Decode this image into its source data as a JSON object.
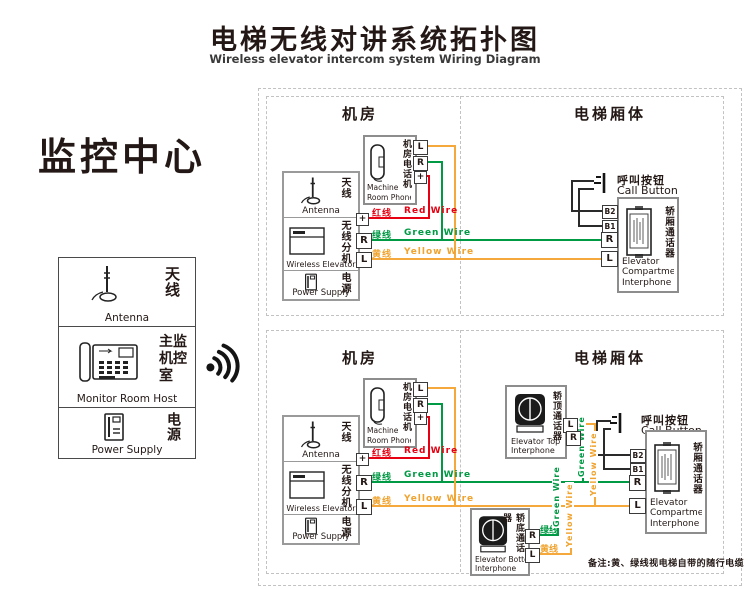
{
  "page": {
    "title_zh": "电梯无线对讲系统拓扑图",
    "title_en": "Wireless elevator intercom system Wiring Diagram",
    "note": "备注:黄、绿线视电梯自带的随行电缆"
  },
  "colors": {
    "red": "#e60012",
    "green": "#009944",
    "yellow": "#f5a93c",
    "box_border": "#8d8d8d"
  },
  "monitoring_center": {
    "title": "监控中心",
    "antenna": {
      "zh": "天线",
      "en": "Antenna"
    },
    "host": {
      "zh_lines": [
        "主监",
        "机控",
        "室"
      ],
      "en": "Monitor Room Host"
    },
    "power": {
      "zh": "电源",
      "en": "Power Supply"
    }
  },
  "upper": {
    "room_label": "机房",
    "car_label": "电梯厢体",
    "machine_phone": {
      "zh": "机房电话机",
      "en1": "Machine",
      "en2": "Room Phone",
      "t_l": "L",
      "t_r": "R",
      "t_plus": "+"
    },
    "station": {
      "antenna_zh": "天线",
      "antenna_en": "Antenna",
      "wireless_zh": "无线分机",
      "wireless_en": "Wireless Elevator",
      "power_zh": "电源",
      "power_en": "Power Supply",
      "t_plus": "+",
      "t_r": "R",
      "t_l": "L"
    },
    "wire_red": {
      "zh": "红线",
      "en": "Red Wire"
    },
    "wire_green": {
      "zh": "绿线",
      "en": "Green Wire"
    },
    "wire_yellow": {
      "zh": "黄线",
      "en": "Yellow Wire"
    },
    "call_button": {
      "zh": "呼叫按钮",
      "en": "Call Button"
    },
    "interphone": {
      "zh": "轿厢通话器",
      "en1": "Elevator",
      "en2": "Compartment",
      "en3": "Interphone",
      "t_b2": "B2",
      "t_b1": "B1",
      "t_r": "R",
      "t_l": "L"
    }
  },
  "lower": {
    "room_label": "机房",
    "car_label": "电梯厢体",
    "machine_phone": {
      "zh": "机房电话机",
      "en1": "Machine",
      "en2": "Room Phone",
      "t_l": "L",
      "t_r": "R",
      "t_plus": "+"
    },
    "station": {
      "antenna_zh": "天线",
      "antenna_en": "Antenna",
      "wireless_zh": "无线分机",
      "wireless_en": "Wireless Elevator",
      "power_zh": "电源",
      "power_en": "Power Supply",
      "t_plus": "+",
      "t_r": "R",
      "t_l": "L"
    },
    "wire_red": {
      "zh": "红线",
      "en": "Red Wire"
    },
    "wire_green": {
      "zh": "绿线",
      "en": "Green Wire"
    },
    "wire_yellow": {
      "zh": "黄线",
      "en": "Yellow Wire"
    },
    "call_button": {
      "zh": "呼叫按钮",
      "en": "Call Button"
    },
    "interphone": {
      "zh": "轿厢通话器",
      "en1": "Elevator",
      "en2": "Compartment",
      "en3": "Interphone",
      "t_b2": "B2",
      "t_b1": "B1",
      "t_r": "R",
      "t_l": "L"
    },
    "top_interphone": {
      "zh": "轿顶通话器",
      "en1": "Elevator Top",
      "en2": "Interphone",
      "t_l": "L",
      "t_r": "R"
    },
    "bottom_interphone": {
      "zh": "轿底通话器",
      "en1": "Elevator Bottom",
      "en2": "Interphone",
      "t_r": "R",
      "t_l": "L",
      "green_label": "绿线",
      "yellow_label": "黄线"
    },
    "v_green": "Green Wire",
    "v_yellow": "Yellow Wire"
  }
}
